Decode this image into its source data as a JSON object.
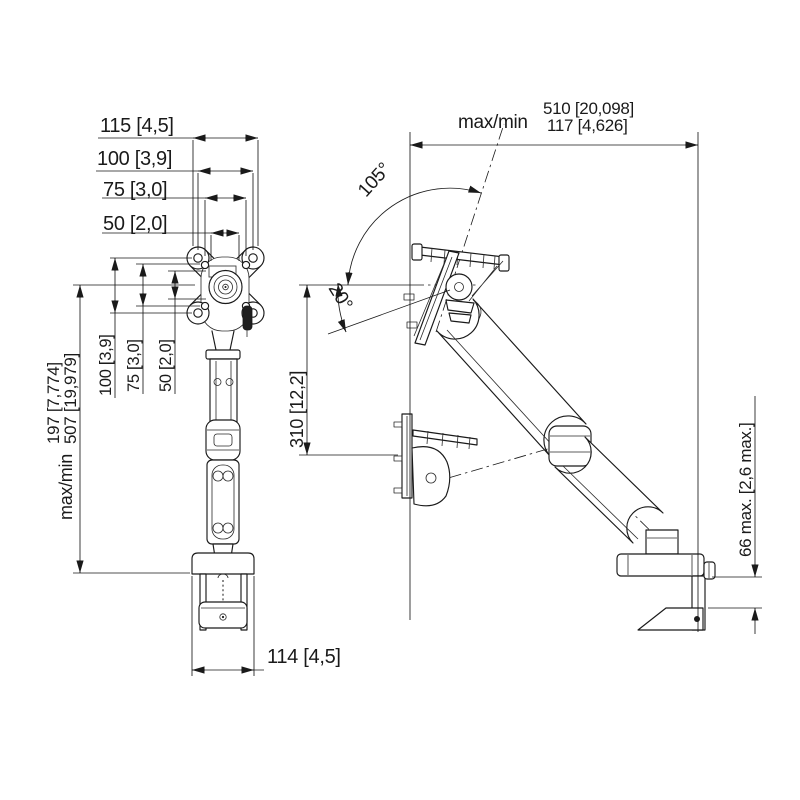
{
  "drawing": {
    "front": {
      "width_dims": [
        "115 [4,5]",
        "100 [3,9]",
        "75 [3,0]",
        "50 [2,0]"
      ],
      "height_dims": [
        "100 [3,9]",
        "75 [3,0]",
        "50 [2,0]"
      ],
      "height_range": {
        "prefix": "max/min",
        "max": "507 [19,979]",
        "min": "197 [7,774]"
      },
      "base_width": "114 [4,5]"
    },
    "side": {
      "reach_range": {
        "prefix": "max/min",
        "max": "510 [20,098]",
        "min": "117 [4,626]"
      },
      "tilt_up_angle": "105°",
      "tilt_down_angle": "20°",
      "vertical_travel": "310 [12,2]",
      "desk_thickness_max": "66 max. [2,6 max.]"
    },
    "colors": {
      "line": "#1a1a1a",
      "background": "#ffffff"
    }
  }
}
